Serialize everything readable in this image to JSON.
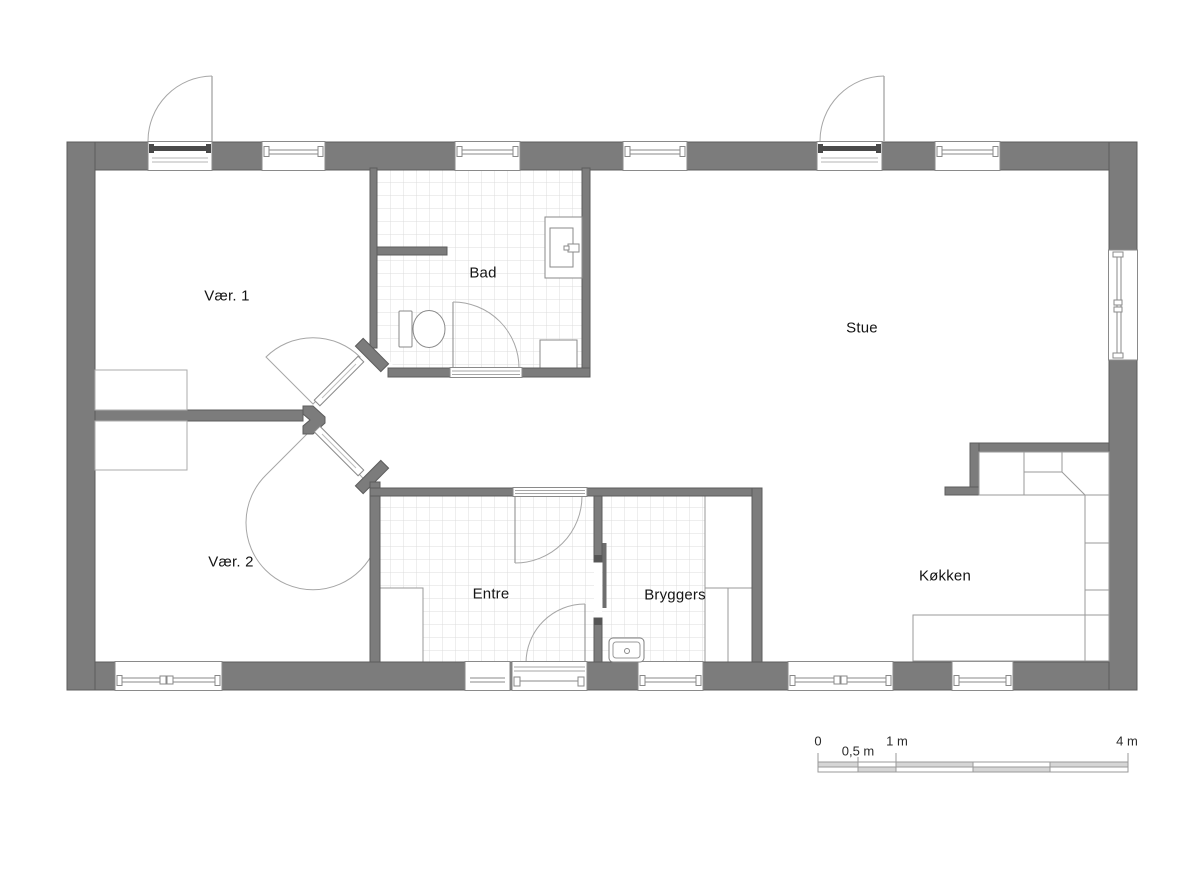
{
  "rooms": [
    {
      "id": "vaer-1",
      "label": "Vær. 1"
    },
    {
      "id": "bad",
      "label": "Bad"
    },
    {
      "id": "stue",
      "label": "Stue"
    },
    {
      "id": "vaer-2",
      "label": "Vær. 2"
    },
    {
      "id": "entre",
      "label": "Entre"
    },
    {
      "id": "bryggers",
      "label": "Bryggers"
    },
    {
      "id": "koekken",
      "label": "Køkken"
    }
  ],
  "scalebar": {
    "labels": [
      "0",
      "0,5 m",
      "1 m",
      "4 m"
    ]
  },
  "fixtures": [
    "toilet",
    "washbasin",
    "utility-sink",
    "wardrobe",
    "closet",
    "kitchen-counter",
    "door-swing",
    "window",
    "sliding-door"
  ],
  "colors": {
    "wall_fill": "#7c7c7c",
    "wall_edge": "#5c5c5c",
    "frame_line": "#8a8a8a",
    "swing_line": "#a6a6a6",
    "tile_line": "#dcdcdc",
    "furniture_line": "#9a9a9a",
    "text": "#141414"
  }
}
